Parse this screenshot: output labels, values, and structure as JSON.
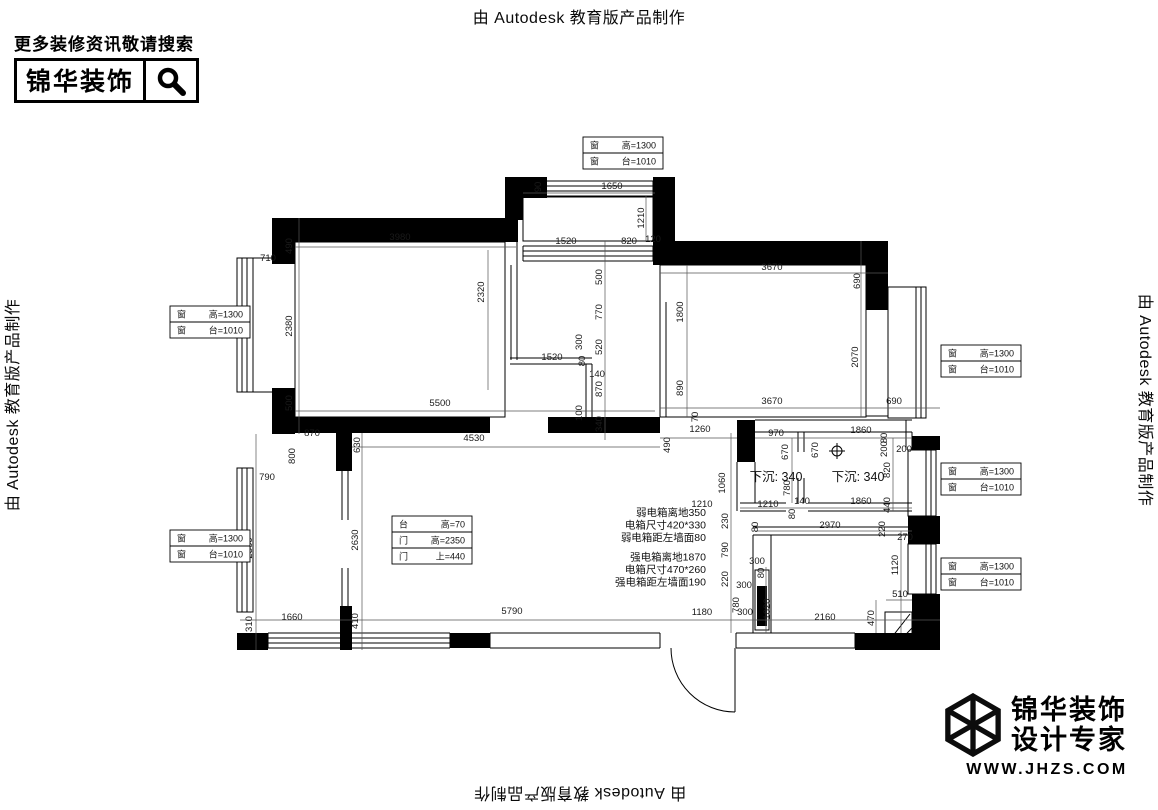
{
  "watermark": {
    "text": "由 Autodesk 教育版产品制作"
  },
  "header_logo": {
    "tagline": "更多装修资讯敬请搜索",
    "brand": "锦华装饰",
    "icon": "search-icon"
  },
  "footer_logo": {
    "brand_line1": "锦华装饰",
    "brand_line2": "设计专家",
    "website": "WWW.JHZS.COM",
    "icon": "cube-3d-icon"
  },
  "plan": {
    "window_box_rows": [
      [
        "窗",
        "高=1300"
      ],
      [
        "窗",
        "台=1010"
      ]
    ],
    "window_boxes": [
      {
        "x": 583,
        "y": 137
      },
      {
        "x": 170,
        "y": 306
      },
      {
        "x": 170,
        "y": 530
      },
      {
        "x": 941,
        "y": 345
      },
      {
        "x": 941,
        "y": 463
      },
      {
        "x": 941,
        "y": 558
      }
    ],
    "door_box": {
      "x": 392,
      "y": 516,
      "rows": [
        [
          "台",
          "高=70"
        ],
        [
          "门",
          "高=2350"
        ],
        [
          "门",
          "上=440"
        ]
      ]
    },
    "sunken_labels": [
      {
        "text": "下沉: 340",
        "x": 776,
        "y": 481
      },
      {
        "text": "下沉: 340",
        "x": 858,
        "y": 481
      }
    ],
    "electrical_notes": {
      "x": 706,
      "y": 516,
      "lines": [
        "弱电箱离地350",
        "电箱尺寸420*330",
        "弱电箱距左墙面80",
        "强电箱离地1870",
        "电箱尺寸470*260",
        "强电箱距左墙面190"
      ]
    },
    "dimensions": [
      {
        "t": "90",
        "x": 541,
        "y": 187,
        "r": -90
      },
      {
        "t": "1650",
        "x": 612,
        "y": 189,
        "r": 0
      },
      {
        "t": "1210",
        "x": 644,
        "y": 218,
        "r": -90
      },
      {
        "t": "1520",
        "x": 566,
        "y": 244,
        "r": 0
      },
      {
        "t": "820",
        "x": 629,
        "y": 244,
        "r": 0
      },
      {
        "t": "120",
        "x": 653,
        "y": 242,
        "r": 0
      },
      {
        "t": "490",
        "x": 292,
        "y": 246,
        "r": -90
      },
      {
        "t": "3980",
        "x": 400,
        "y": 240,
        "r": 0
      },
      {
        "t": "710",
        "x": 268,
        "y": 261,
        "r": 0
      },
      {
        "t": "2380",
        "x": 292,
        "y": 326,
        "r": -90
      },
      {
        "t": "2320",
        "x": 484,
        "y": 292,
        "r": -90
      },
      {
        "t": "500",
        "x": 292,
        "y": 403,
        "r": -90
      },
      {
        "t": "5500",
        "x": 440,
        "y": 406,
        "r": 0
      },
      {
        "t": "500",
        "x": 602,
        "y": 277,
        "r": -90
      },
      {
        "t": "770",
        "x": 602,
        "y": 312,
        "r": -90
      },
      {
        "t": "300",
        "x": 582,
        "y": 342,
        "r": -90
      },
      {
        "t": "520",
        "x": 602,
        "y": 347,
        "r": -90
      },
      {
        "t": "1520",
        "x": 552,
        "y": 360,
        "r": 0
      },
      {
        "t": "80",
        "x": 585,
        "y": 361,
        "r": -90
      },
      {
        "t": "140",
        "x": 597,
        "y": 377,
        "r": 0
      },
      {
        "t": "870",
        "x": 602,
        "y": 389,
        "r": -90
      },
      {
        "t": "100",
        "x": 582,
        "y": 413,
        "r": -90
      },
      {
        "t": "340",
        "x": 602,
        "y": 424,
        "r": -90
      },
      {
        "t": "3670",
        "x": 772,
        "y": 270,
        "r": 0
      },
      {
        "t": "690",
        "x": 860,
        "y": 281,
        "r": -90
      },
      {
        "t": "1800",
        "x": 683,
        "y": 312,
        "r": -90
      },
      {
        "t": "2070",
        "x": 858,
        "y": 357,
        "r": -90
      },
      {
        "t": "890",
        "x": 683,
        "y": 388,
        "r": -90
      },
      {
        "t": "3670",
        "x": 772,
        "y": 404,
        "r": 0
      },
      {
        "t": "690",
        "x": 894,
        "y": 404,
        "r": 0
      },
      {
        "t": "70",
        "x": 698,
        "y": 417,
        "r": -90
      },
      {
        "t": "1260",
        "x": 700,
        "y": 432,
        "r": 0
      },
      {
        "t": "870",
        "x": 312,
        "y": 436,
        "r": 0
      },
      {
        "t": "800",
        "x": 295,
        "y": 456,
        "r": -90
      },
      {
        "t": "630",
        "x": 360,
        "y": 445,
        "r": -90
      },
      {
        "t": "4530",
        "x": 474,
        "y": 441,
        "r": 0
      },
      {
        "t": "790",
        "x": 267,
        "y": 480,
        "r": 0
      },
      {
        "t": "2560",
        "x": 252,
        "y": 548,
        "r": -90
      },
      {
        "t": "2630",
        "x": 358,
        "y": 540,
        "r": -90
      },
      {
        "t": "310",
        "x": 252,
        "y": 624,
        "r": -90
      },
      {
        "t": "1660",
        "x": 292,
        "y": 620,
        "r": 0
      },
      {
        "t": "410",
        "x": 358,
        "y": 621,
        "r": -90
      },
      {
        "t": "490",
        "x": 670,
        "y": 445,
        "r": -90
      },
      {
        "t": "970",
        "x": 776,
        "y": 436,
        "r": 0
      },
      {
        "t": "670",
        "x": 788,
        "y": 452,
        "r": -90
      },
      {
        "t": "670",
        "x": 818,
        "y": 450,
        "r": -90
      },
      {
        "t": "1860",
        "x": 861,
        "y": 433,
        "r": 0
      },
      {
        "t": "80",
        "x": 887,
        "y": 438,
        "r": -90
      },
      {
        "t": "200",
        "x": 887,
        "y": 449,
        "r": -90
      },
      {
        "t": "200",
        "x": 904,
        "y": 452,
        "r": 0
      },
      {
        "t": "1060",
        "x": 725,
        "y": 483,
        "r": -90
      },
      {
        "t": "780",
        "x": 790,
        "y": 488,
        "r": -90
      },
      {
        "t": "820",
        "x": 890,
        "y": 470,
        "r": -90
      },
      {
        "t": "440",
        "x": 890,
        "y": 505,
        "r": -90
      },
      {
        "t": "1210",
        "x": 702,
        "y": 507,
        "r": 0
      },
      {
        "t": "1210",
        "x": 768,
        "y": 507,
        "r": 0
      },
      {
        "t": "140",
        "x": 802,
        "y": 504,
        "r": 0
      },
      {
        "t": "80",
        "x": 795,
        "y": 514,
        "r": -90
      },
      {
        "t": "1860",
        "x": 861,
        "y": 504,
        "r": 0
      },
      {
        "t": "230",
        "x": 728,
        "y": 521,
        "r": -90
      },
      {
        "t": "80",
        "x": 758,
        "y": 527,
        "r": -90
      },
      {
        "t": "2970",
        "x": 830,
        "y": 528,
        "r": 0
      },
      {
        "t": "220",
        "x": 885,
        "y": 529,
        "r": -90
      },
      {
        "t": "270",
        "x": 905,
        "y": 540,
        "r": 0
      },
      {
        "t": "790",
        "x": 728,
        "y": 550,
        "r": -90
      },
      {
        "t": "300",
        "x": 757,
        "y": 564,
        "r": 0
      },
      {
        "t": "80",
        "x": 764,
        "y": 573,
        "r": -90
      },
      {
        "t": "1120",
        "x": 898,
        "y": 565,
        "r": -90
      },
      {
        "t": "220",
        "x": 728,
        "y": 579,
        "r": -90
      },
      {
        "t": "300",
        "x": 744,
        "y": 588,
        "r": 0
      },
      {
        "t": "780",
        "x": 739,
        "y": 605,
        "r": -90
      },
      {
        "t": "1020",
        "x": 770,
        "y": 609,
        "r": -90
      },
      {
        "t": "510",
        "x": 900,
        "y": 597,
        "r": 0
      },
      {
        "t": "470",
        "x": 874,
        "y": 618,
        "r": -90
      },
      {
        "t": "2160",
        "x": 825,
        "y": 620,
        "r": 0
      },
      {
        "t": "5790",
        "x": 512,
        "y": 614,
        "r": 0
      },
      {
        "t": "1180",
        "x": 702,
        "y": 615,
        "r": 0
      },
      {
        "t": "300",
        "x": 745,
        "y": 615,
        "r": 0
      }
    ]
  }
}
